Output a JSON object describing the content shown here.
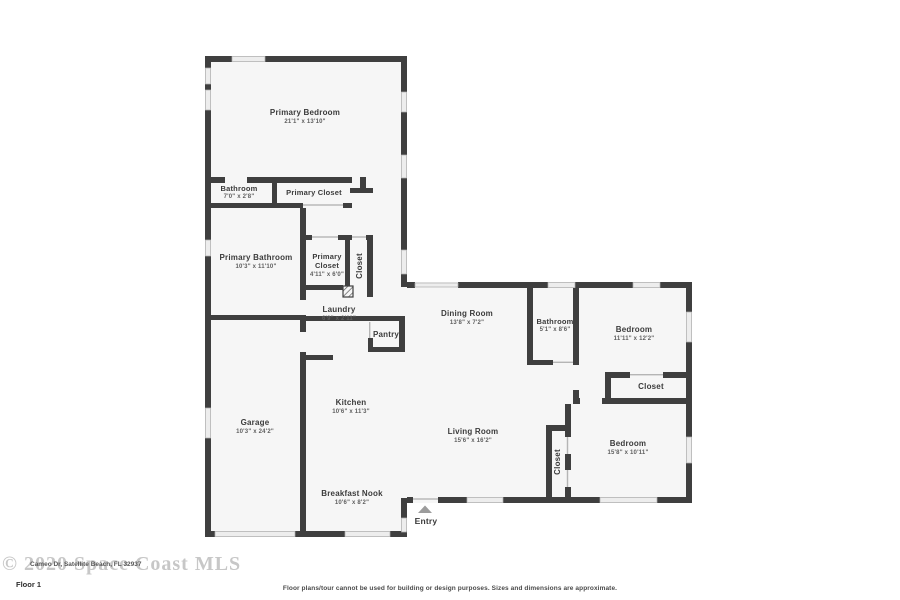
{
  "rooms": [
    {
      "name": "Primary Bedroom",
      "dims": "21'1\" x 13'10\""
    },
    {
      "name": "Bathroom",
      "dims": "7'0\" x 2'8\""
    },
    {
      "name": "Primary Closet",
      "dims": ""
    },
    {
      "name": "Primary Bathroom",
      "dims": "10'3\" x 11'10\""
    },
    {
      "name": "Primary Closet",
      "dims": "4'11\" x 6'0\""
    },
    {
      "name": "Closet",
      "dims": ""
    },
    {
      "name": "Laundry",
      "dims": "6'9\" x 2'11\""
    },
    {
      "name": "Pantry",
      "dims": ""
    },
    {
      "name": "Dining Room",
      "dims": "13'8\" x 7'2\""
    },
    {
      "name": "Bathroom",
      "dims": "5'1\" x 8'6\""
    },
    {
      "name": "Bedroom",
      "dims": "11'11\" x 12'2\""
    },
    {
      "name": "Closet",
      "dims": ""
    },
    {
      "name": "Garage",
      "dims": "10'3\" x 24'2\""
    },
    {
      "name": "Kitchen",
      "dims": "10'6\" x 11'3\""
    },
    {
      "name": "Living Room",
      "dims": "15'6\" x 16'2\""
    },
    {
      "name": "Closet",
      "dims": ""
    },
    {
      "name": "Bedroom",
      "dims": "15'8\" x 10'11\""
    },
    {
      "name": "Breakfast Nook",
      "dims": "10'6\" x 8'2\""
    },
    {
      "name": "Entry",
      "dims": ""
    }
  ],
  "footer": {
    "watermark": "© 2020 Space Coast MLS",
    "address": "Cameo Dr, Satellite Beach, FL 32937",
    "floor_label": "Floor 1",
    "disclaimer": "Floor plans/tour cannot be used for building or design purposes. Sizes and dimensions are approximate."
  },
  "colors": {
    "wall": "#3f3f3f",
    "floor": "#f6f6f6",
    "window": "#ededed",
    "window_frame": "#aeaeae",
    "entry_marker": "#9c9c9c",
    "watermark": "#c7c7c7"
  }
}
